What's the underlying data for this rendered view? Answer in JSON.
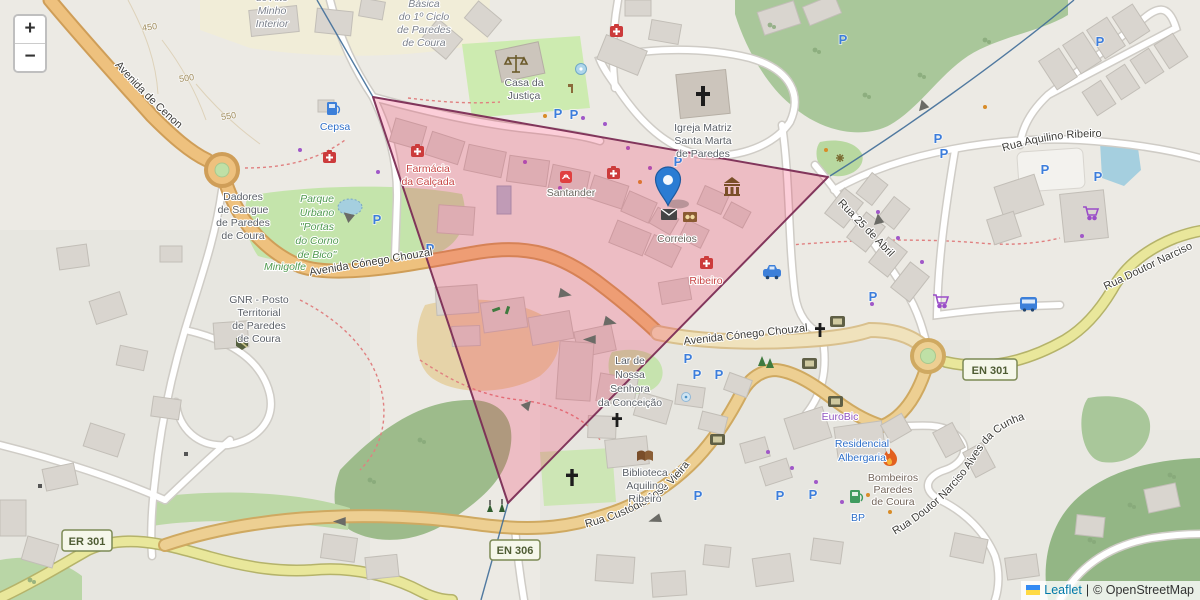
{
  "controls": {
    "zoom_in": "+",
    "zoom_out": "−"
  },
  "attribution": {
    "flag": "ukraine-flag",
    "leaflet": "Leaflet",
    "divider": "|",
    "osm": "© OpenStreetMap"
  },
  "icons": {
    "parking": "P"
  },
  "shields": {
    "en301": "EN 301",
    "er301": "ER 301",
    "en306": "EN 306"
  },
  "contours": {
    "c450": "450",
    "c500": "500",
    "c550": "550"
  },
  "roads": {
    "cenon": "Avenida de Cenon",
    "chouzal_w": "Avenida Cónego Chouzal",
    "chouzal_c": "Avenida Cónego Chouzal",
    "aquilino": "Rua Aquilino Ribeiro",
    "abril": "Rua 25 de Abril",
    "narciso": "Rua Doutor Narciso",
    "custodio": "Rua Custódio José Vieira",
    "cunha": "Rua Doutor Narciso Alves da Cunha"
  },
  "pois": {
    "school_left": [
      "do Alto",
      "Minho",
      "Interior"
    ],
    "school_right": [
      "Básica",
      "do 1º Ciclo",
      "de Paredes",
      "de Coura"
    ],
    "casa_justica": [
      "Casa da",
      "Justiça"
    ],
    "igreja": [
      "Igreja Matriz",
      "Santa Marta",
      "de Paredes"
    ],
    "cepsa": "Cepsa",
    "dadores": [
      "Dadores",
      "de Sangue",
      "de Paredes",
      "de Coura"
    ],
    "parque": [
      "Parque",
      "Urbano",
      "\"Portas",
      "do Corno",
      "de Bico\""
    ],
    "minigolfe": "Minigolfe",
    "gnr": [
      "GNR - Posto",
      "Territorial",
      "de Paredes",
      "de Coura"
    ],
    "farmacia": [
      "Farmácia",
      "da Calçada"
    ],
    "santander": "Santander",
    "correios": "Correios",
    "ribeiro": "Ribeiro",
    "lar": [
      "Lar de",
      "Nossa",
      "Senhora",
      "da Conceição"
    ],
    "biblioteca": [
      "Biblioteca",
      "Aquilino",
      "Ribeiro"
    ],
    "eurobic": "EuroBic",
    "residencial": [
      "Residencial",
      "Albergaria"
    ],
    "bombeiros": [
      "Bombeiros",
      "Paredes",
      "de Coura"
    ],
    "bp": "BP"
  },
  "colors": {
    "polygon_fill": "#f22050",
    "polygon_stroke": "#7c2d55",
    "marker_blue": "#2b7cd3",
    "road_orange": "#eec17e",
    "road_yellow": "#e9e79b",
    "leaflet_link": "#0078A8"
  }
}
